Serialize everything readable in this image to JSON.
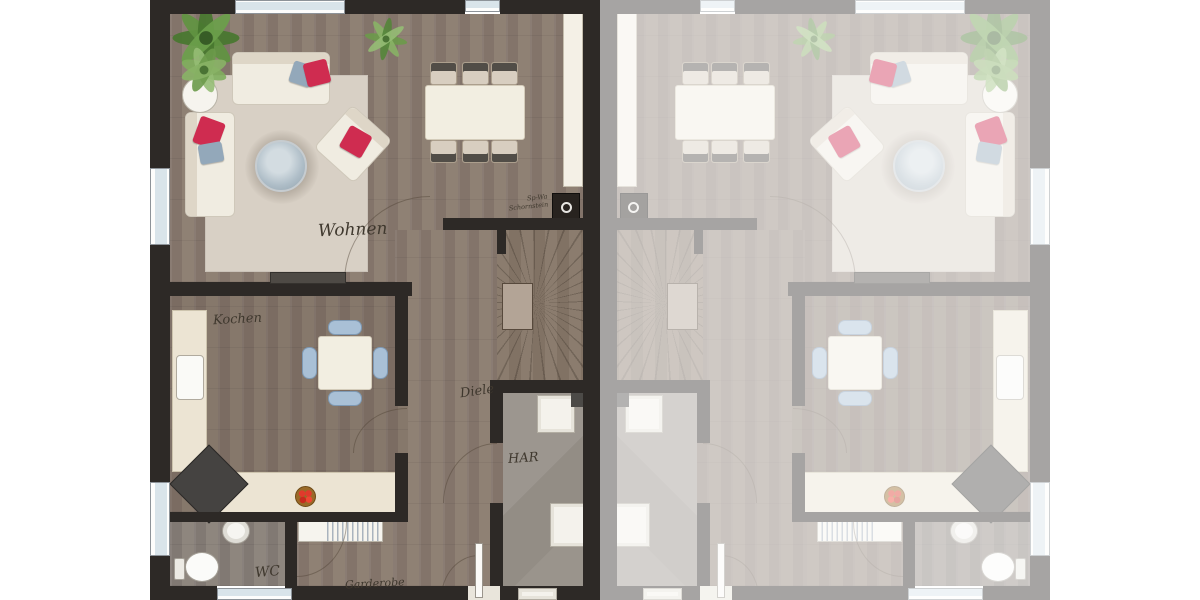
{
  "floorplan": {
    "description": "semi-detached house ground floor plan, left unit full color, right unit mirrored and faded",
    "units": [
      {
        "name": "left",
        "appearance": "full-color"
      },
      {
        "name": "right",
        "appearance": "mirrored-faded"
      }
    ],
    "rooms": {
      "living": "Wohnen",
      "kitchen": "Kochen",
      "hallway": "Diele",
      "utility": "HAR",
      "wc": "WC",
      "cloakroom": "Garderobe"
    },
    "annotations": {
      "chimney_line1": "Sp-Wa",
      "chimney_line2": "Schornstein"
    },
    "colors": {
      "wall": "#2d2926",
      "wood_a": "#8f8174",
      "wood_b": "#83746a",
      "rug": "#d8d0c5",
      "furn": "#f0ece1",
      "pillow_red": "#cf2c50",
      "pillow_blue": "#93a8ba",
      "counter": "#ece4d3",
      "chair_blue": "#a9c0d6",
      "utility_floor": "#98928a",
      "glass": "#d9e4ea"
    }
  }
}
